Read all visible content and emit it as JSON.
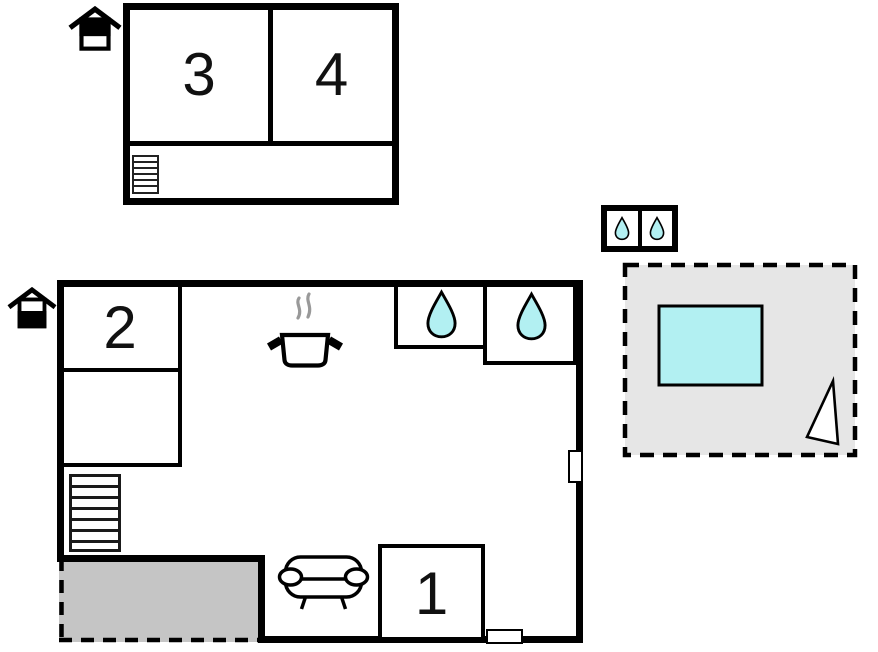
{
  "colors": {
    "wall": "#000000",
    "water": "#b2f0f2",
    "terrace_fill": "#e6e6e6",
    "patio_fill": "#c5c5c5",
    "steam": "#999999"
  },
  "upper_floor": {
    "rooms": [
      {
        "id": "room-3",
        "label": "3"
      },
      {
        "id": "room-4",
        "label": "4"
      }
    ],
    "features": [
      "staircase"
    ],
    "level_icon": "upper-level"
  },
  "main_floor": {
    "rooms": [
      {
        "id": "room-2",
        "label": "2"
      },
      {
        "id": "room-1",
        "label": "1"
      }
    ],
    "features": [
      "kitchen-pot",
      "bathroom-drop",
      "bathroom-drop",
      "staircase",
      "sofa",
      "covered-patio",
      "window-right",
      "window-bottom"
    ],
    "level_icon": "ground-level"
  },
  "annex": {
    "shower_count": 2
  },
  "terrace": {
    "features": [
      "pool",
      "flag"
    ]
  }
}
